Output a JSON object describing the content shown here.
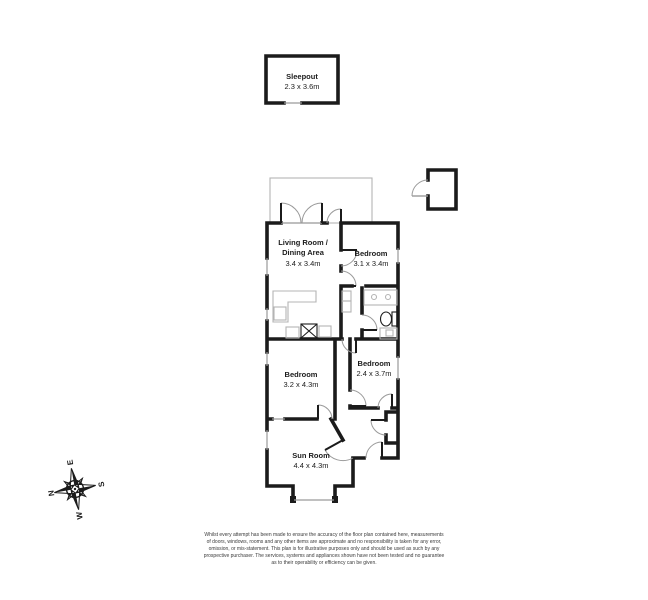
{
  "floorplan": {
    "rooms": [
      {
        "name": "Sleepout",
        "dims": "2.3 x 3.6m"
      },
      {
        "name": "Living Room /",
        "name2": "Dining Area",
        "dims": "3.4 x 3.4m"
      },
      {
        "name": "Bedroom",
        "dims": "3.1 x 3.4m"
      },
      {
        "name": "Bedroom",
        "dims": "2.4 x 3.7m"
      },
      {
        "name": "Bedroom",
        "dims": "3.2 x 4.3m"
      },
      {
        "name": "Sun Room",
        "dims": "4.4 x 4.3m"
      }
    ],
    "compass": {
      "north": "N",
      "east": "E",
      "south": "S",
      "west": "W"
    },
    "colors": {
      "wall": "#1b1b1b",
      "light_outline": "#b4b4b4",
      "door_arc": "#9a9a9a",
      "label_text": "#1b1b1b",
      "disclaimer_text": "#3a3a3a",
      "background": "#ffffff"
    }
  },
  "disclaimer": {
    "lines": [
      "Whilst every attempt has been made to ensure the accuracy of the floor plan contained here, measurements",
      "of doors, windows, rooms and any other items are approximate and no responsibility is taken for any error,",
      "omission, or mis-statement. This plan is for illustrative purposes only and should be used as such by any",
      "prospective purchaser. The services, systems and appliances shown have not been tested and no guarantee",
      "as to their operability or efficiency can be given."
    ]
  }
}
